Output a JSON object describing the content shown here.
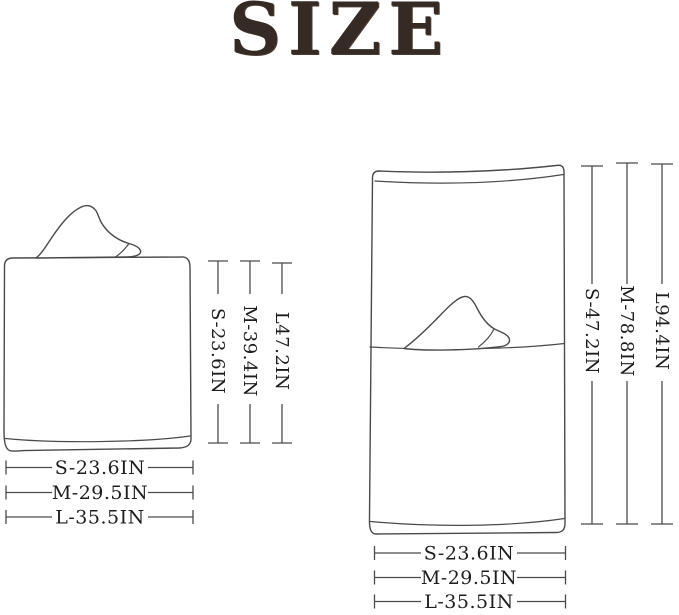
{
  "title": "SIZE",
  "colors": {
    "title_ink": "#362a24",
    "drawing_line": "#4a4a4a",
    "label_ink": "#1d1d1d",
    "background": "#ffffff"
  },
  "folded_figure": {
    "height_labels": [
      "S-23.6IN",
      "M-39.4IN",
      "L47.2IN"
    ],
    "width_labels": [
      "S-23.6IN",
      "M-29.5IN",
      "L-35.5IN"
    ]
  },
  "open_figure": {
    "height_labels": [
      "S-47.2IN",
      "M-78.8IN",
      "L94.4IN"
    ],
    "width_labels": [
      "S-23.6IN",
      "M-29.5IN",
      "L-35.5IN"
    ]
  }
}
